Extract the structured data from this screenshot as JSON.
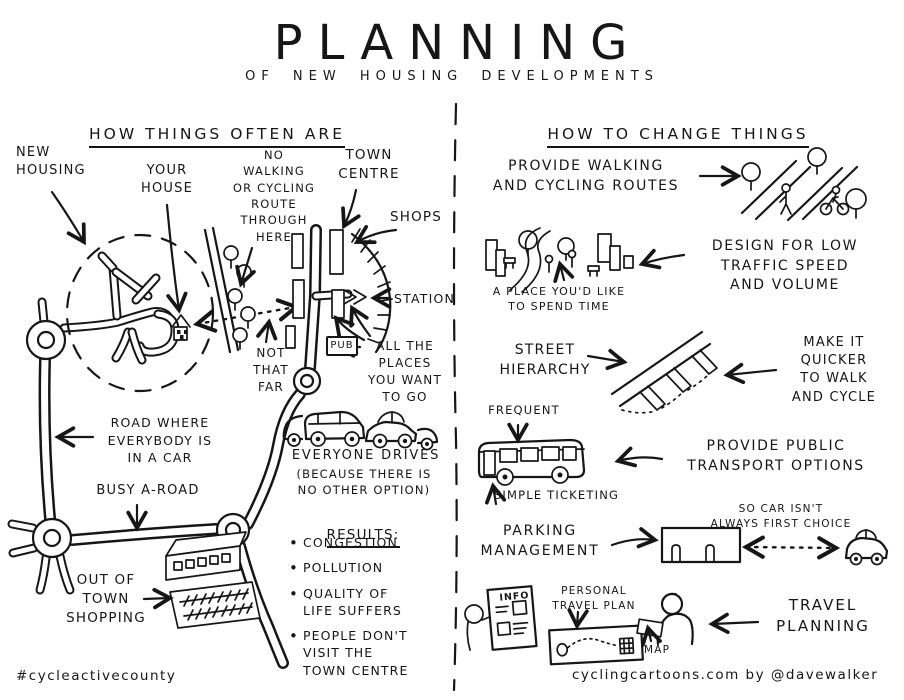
{
  "title": "PLANNING",
  "subtitle": "OF NEW HOUSING DEVELOPMENTS",
  "left": {
    "header": "HOW THINGS OFTEN ARE",
    "labels": {
      "new_housing": "NEW\nHOUSING",
      "your_house": "YOUR\nHOUSE",
      "no_route": "NO\nWALKING\nOR CYCLING\nROUTE\nTHROUGH\nHERE",
      "town_centre": "TOWN\nCENTRE",
      "shops": "SHOPS",
      "station": "STATION",
      "pub": "PUB",
      "not_that_far": "NOT\nTHAT\nFAR",
      "all_places": "ALL THE\nPLACES\nYOU WANT\nTO GO",
      "road_everybody": "ROAD WHERE\nEVERYBODY IS\nIN A CAR",
      "busy_a_road": "BUSY A-ROAD",
      "everyone_drives": "EVERYONE DRIVES",
      "everyone_drives_note": "(BECAUSE THERE IS\nNO OTHER OPTION)",
      "out_of_town": "OUT OF\nTOWN\nSHOPPING"
    },
    "results": {
      "header": "RESULTS:",
      "items": [
        "CONGESTION",
        "POLLUTION",
        "QUALITY OF\nLIFE SUFFERS",
        "PEOPLE DON'T\nVISIT THE\nTOWN CENTRE"
      ]
    }
  },
  "right": {
    "header": "HOW TO CHANGE THINGS",
    "labels": {
      "provide_walking": "PROVIDE WALKING\nAND CYCLING ROUTES",
      "place_spend_time": "A PLACE YOU'D LIKE\nTO SPEND TIME",
      "design_low_traffic": "DESIGN FOR LOW\nTRAFFIC SPEED\nAND VOLUME",
      "street_hierarchy": "STREET\nHIERARCHY",
      "make_it_quicker": "MAKE IT\nQUICKER\nTO WALK\nAND CYCLE",
      "frequent": "FREQUENT",
      "simple_ticketing": "SIMPLE TICKETING",
      "public_transport": "PROVIDE PUBLIC\nTRANSPORT OPTIONS",
      "parking_management": "PARKING\nMANAGEMENT",
      "so_car": "SO CAR ISN'T\nALWAYS FIRST CHOICE",
      "personal_travel_plan": "PERSONAL\nTRAVEL PLAN",
      "info": "INFO",
      "map": "MAP",
      "travel_planning": "TRAVEL\nPLANNING"
    }
  },
  "footer": {
    "hashtag": "#cycleactivecounty",
    "credit": "cyclingcartoons.com by @davewalker"
  },
  "colors": {
    "ink": "#161616",
    "background": "#ffffff"
  }
}
